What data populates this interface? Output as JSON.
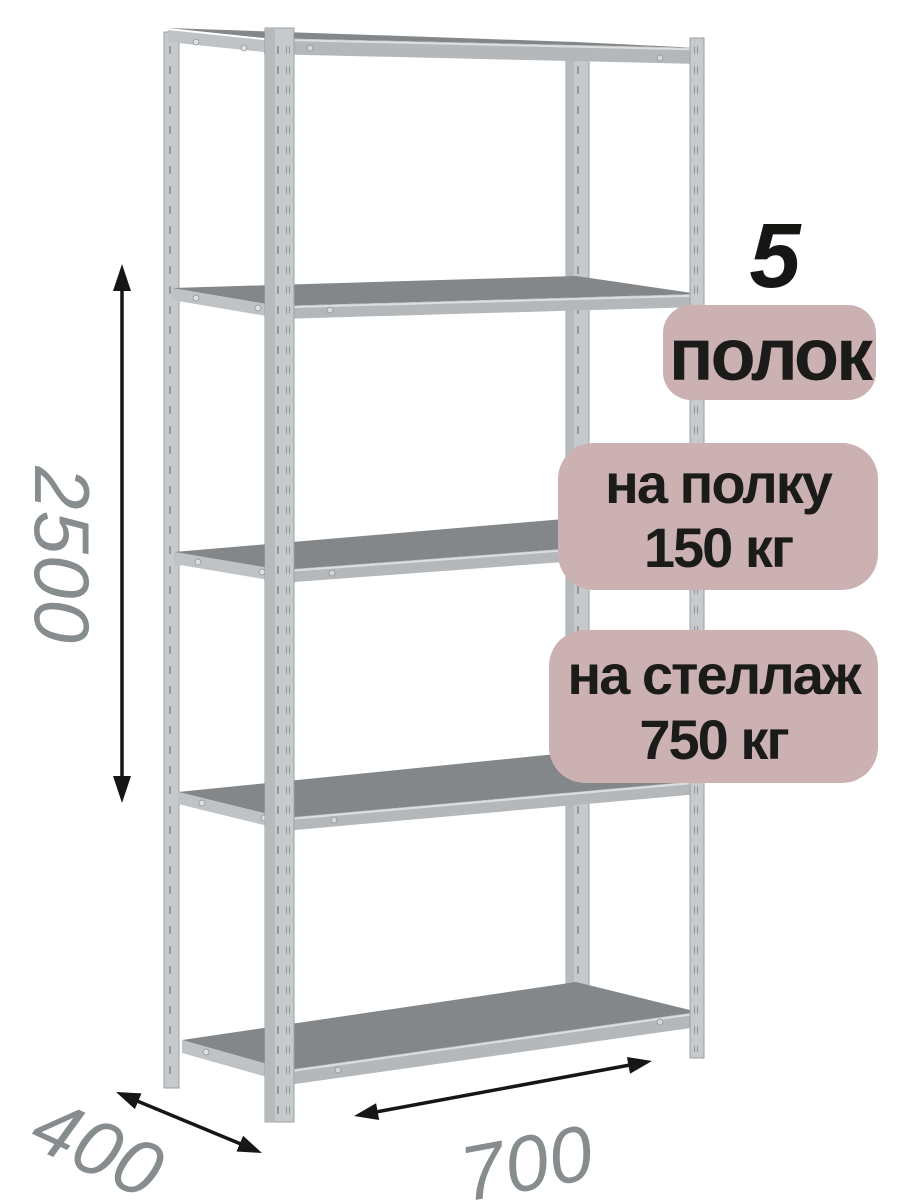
{
  "dimensions": {
    "height": "2500",
    "depth": "400",
    "width": "700"
  },
  "badges": {
    "shelf_count": "5",
    "shelf_count_label": "полок",
    "per_shelf": {
      "line1": "на полку",
      "line2": "150 кг"
    },
    "per_rack": {
      "line1": "на стеллаж",
      "line2": "750 кг"
    }
  },
  "colors": {
    "background": "#ffffff",
    "badge_background": "#cbb1b1",
    "badge_text": "#1b1b19",
    "dimension_text": "#878c8f",
    "dimension_arrow": "#161616",
    "metal_post": "#c7cacc",
    "metal_edge": "#b4b8ba",
    "shelf_surface": "#83878a"
  }
}
